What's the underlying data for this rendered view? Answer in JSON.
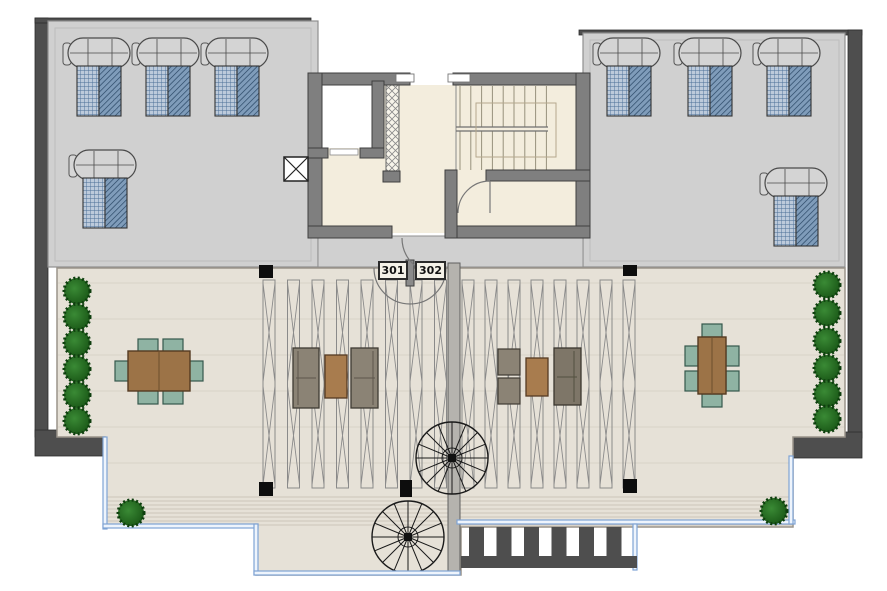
{
  "units": [
    {
      "label": "301"
    },
    {
      "label": "302"
    }
  ],
  "features": {
    "sun_loungers": 8,
    "shrub_planters": 14,
    "spiral_staircases": 2,
    "dining_sets": 2,
    "lounge_sofa_sets": 2,
    "pergola_louver_bays": 2,
    "stair_flights": 2,
    "elevator_shafts": 1,
    "roof_hatch_marker": "x-box"
  },
  "colors": {
    "roof_deck": "#d0d0d0",
    "terrace_paving": "#e6e1d7",
    "structural_wall": "#7f7f7f",
    "dark_parapet": "#4e4e4e",
    "stair_core_floor": "#f3eddd",
    "glass_railing": "#7fa3d4",
    "planting_green": "#1c5c1a",
    "timber_furniture": "#9c7347",
    "outdoor_chair_teal": "#8fb3a3",
    "lounger_hatch_blue": "#7f9cba"
  }
}
